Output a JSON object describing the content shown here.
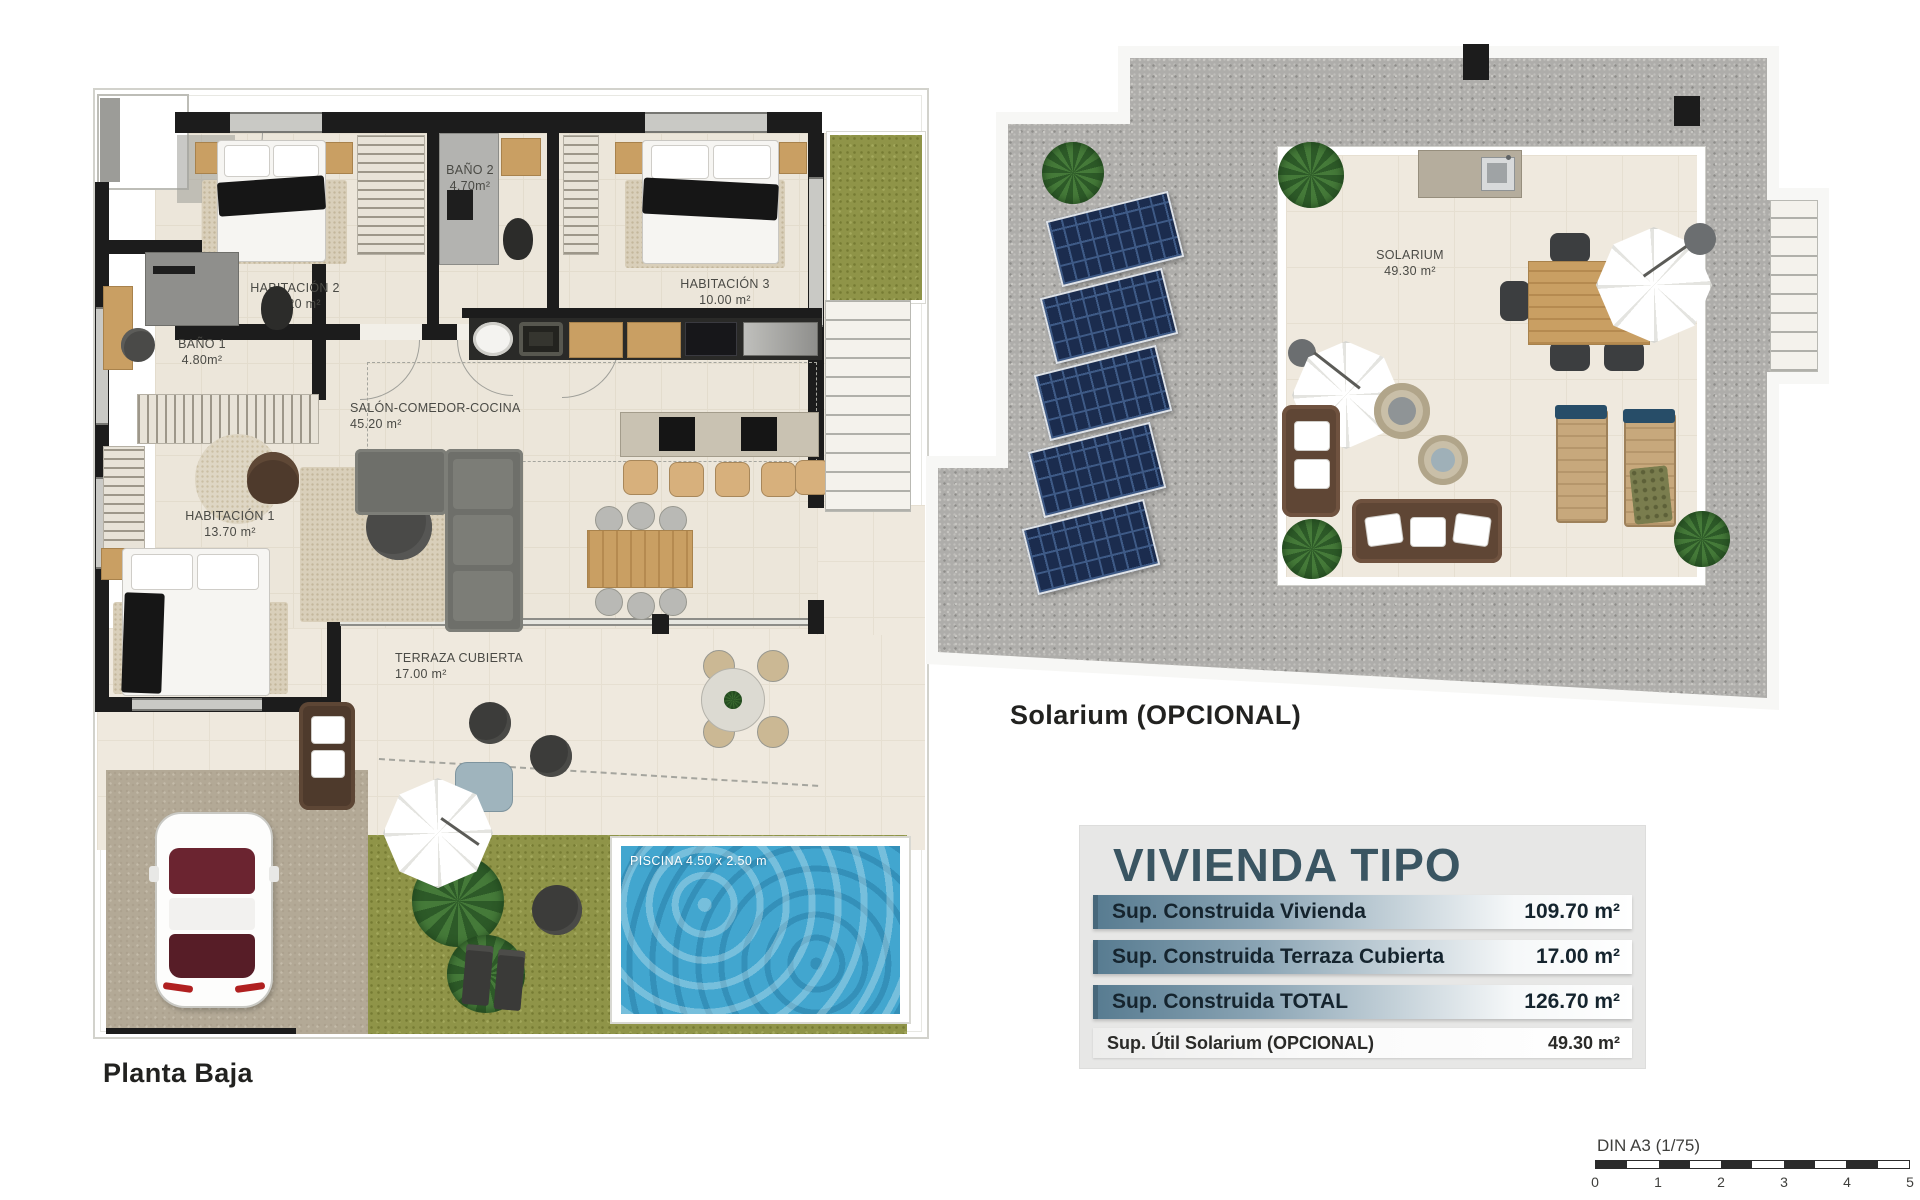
{
  "plans": {
    "planta_baja": {
      "caption": "Planta Baja",
      "rooms": [
        {
          "id": "habitacion2",
          "name": "HABITACIÓN 2",
          "area": "10.20 m²"
        },
        {
          "id": "bano2",
          "name": "BAÑO 2",
          "area": "4.70m²"
        },
        {
          "id": "habitacion3",
          "name": "HABITACIÓN 3",
          "area": "10.00 m²"
        },
        {
          "id": "bano1",
          "name": "BAÑO 1",
          "area": "4.80m²"
        },
        {
          "id": "salon",
          "name": "SALÓN-COMEDOR-COCINA",
          "area": "45.20 m²"
        },
        {
          "id": "habitacion1",
          "name": "HABITACIÓN 1",
          "area": "13.70 m²"
        },
        {
          "id": "terraza",
          "name": "TERRAZA CUBIERTA",
          "area": "17.00 m²"
        }
      ],
      "pool_label": "PISCINA 4.50 x 2.50 m"
    },
    "solarium": {
      "caption": "Solarium (OPCIONAL)",
      "room": {
        "name": "SOLARIUM",
        "area": "49.30 m²"
      }
    }
  },
  "summary_table": {
    "title": "VIVIENDA TIPO",
    "rows": [
      {
        "label": "Sup. Construida Vivienda",
        "value": "109.70 m²"
      },
      {
        "label": "Sup. Construida Terraza Cubierta",
        "value": "17.00 m²"
      },
      {
        "label": "Sup. Construida TOTAL",
        "value": "126.70 m²"
      },
      {
        "label": "Sup. Útil Solarium (OPCIONAL)",
        "value": "49.30 m²"
      }
    ]
  },
  "scale_bar": {
    "label": "DIN A3 (1/75)",
    "ticks": [
      "0",
      "1",
      "2",
      "3",
      "4",
      "5"
    ]
  },
  "colors": {
    "table_title": "#3a5562",
    "row_gradient_start": "#587c91",
    "row_gradient_end": "#ffffff",
    "pool_water": "#42a6cf",
    "grass": "#8f9448",
    "gravel": "#aeadaa",
    "solar_panel": "#1b2c4e",
    "wall": "#1c1c1c",
    "floor_tile": "#ece6da"
  }
}
